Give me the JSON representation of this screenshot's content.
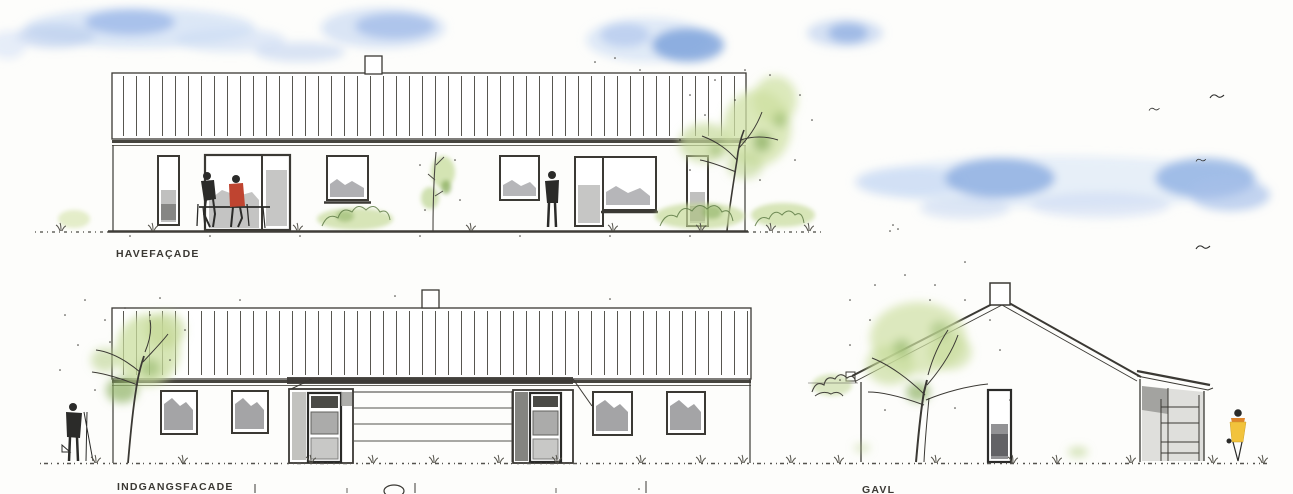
{
  "sheet": {
    "elevations": [
      {
        "id": "havefacade",
        "label": "HAVEFAÇADE"
      },
      {
        "id": "indgangsfacade",
        "label": "INDGANGSFACADE"
      },
      {
        "id": "gavl",
        "label": "GAVL"
      }
    ]
  },
  "palette": {
    "paper": "#fdfdfb",
    "ink": "#3b3934",
    "glass_wash": "#8d8d8b",
    "foliage_light": "#cfe0a4",
    "foliage_dark": "#8fb264",
    "sky_light": "#d3e1f5",
    "sky_dense": "#7fa3dc",
    "figure_red": "#bf4430",
    "figure_yellow": "#f2c33c",
    "figure_dark": "#2b2b29"
  }
}
